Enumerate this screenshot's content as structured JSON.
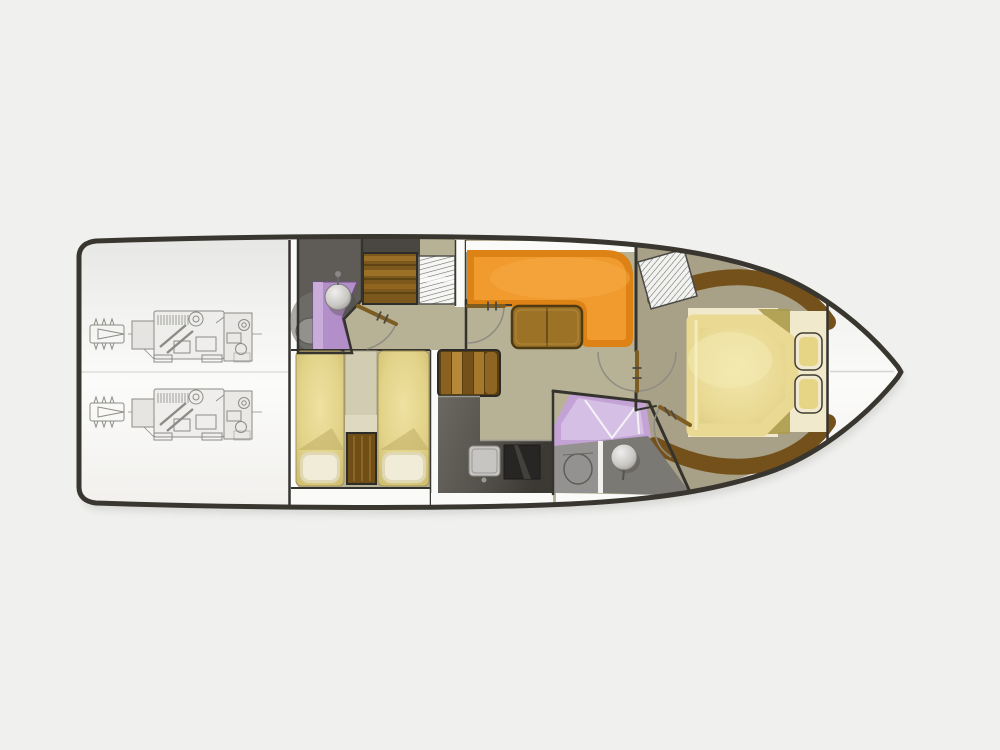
{
  "diagram": {
    "type": "boat-floorplan",
    "view": "overhead-lower-deck-plan",
    "engine_count": 2
  },
  "rooms": [
    {
      "id": "engine-room"
    },
    {
      "id": "aft-head"
    },
    {
      "id": "twin-guest-cabin"
    },
    {
      "id": "companionway-stairs"
    },
    {
      "id": "salon"
    },
    {
      "id": "galley"
    },
    {
      "id": "day-head"
    },
    {
      "id": "master-cabin"
    },
    {
      "id": "bow-locker"
    }
  ],
  "colors": {
    "background": "#f0f0ee",
    "hull_outline": "#39362f",
    "wall_white": "#fafaf8",
    "wall_dark": "#35332d",
    "floor_tan": "#b7b195",
    "floor_master": "#a8a187",
    "head_floor_dark": "#5f5c58",
    "head_floor_gray": "#949290",
    "head_floor_gray_dark": "#7b7974",
    "purple": "#b28fc8",
    "purple_light": "#cdb2dd",
    "purple_shower": "#c3a3d6",
    "shower_light": "#d5bfe4",
    "sofa_edge": "#dd8316",
    "sofa_cushion": "#f19a2e",
    "table_wood": "#9c7227",
    "pillow": "#f1ecd7",
    "wood_dark": "#5a3f0e",
    "trim_brown": "#74511a",
    "platform": "#f1e9cc",
    "seat_inner": "#e6d584",
    "counter_sink": "#c6c5c1",
    "stove": "#282624",
    "engine_line": "#7b7974",
    "door_bar": "#7d5d22",
    "arc_line": "#8e8c82",
    "hatch_line": "#4c4a45",
    "bow_seam": "#d8d6d2"
  }
}
